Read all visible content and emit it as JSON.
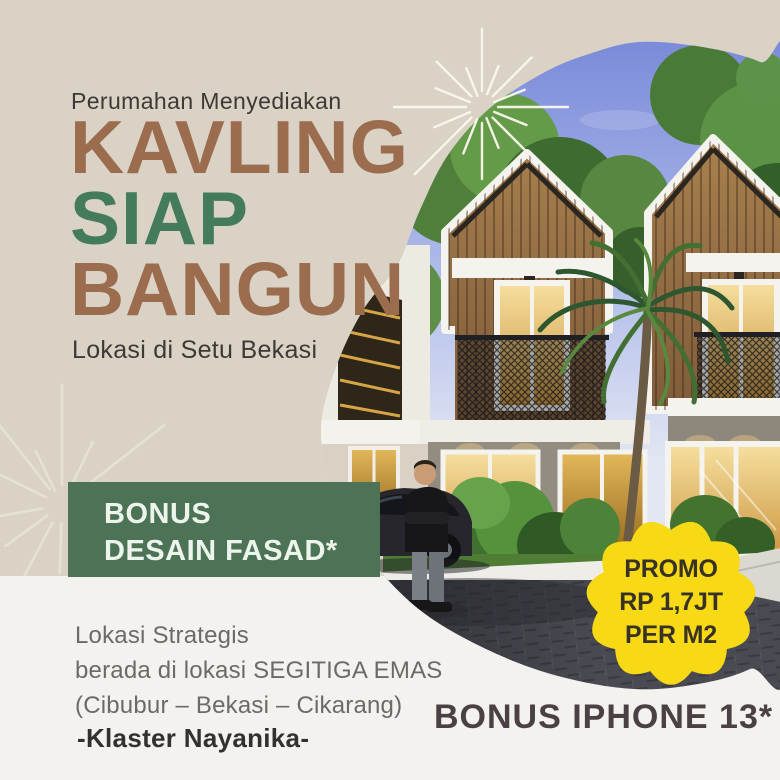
{
  "colors": {
    "canvasBeige": "#D9D2C5",
    "canvasWhite": "#F3F2EF",
    "titleBrown": "#9C6C4E",
    "titleGreen": "#447B5B",
    "ink": "#3E3936",
    "muted": "#6E6966",
    "bannerGreen": "#4D7357",
    "bannerInk": "#EDF4EC",
    "badgeYellow": "#F7D916",
    "badgeInk": "#383226",
    "bonusInk": "#4B4145",
    "clusterInk": "#353030"
  },
  "header": {
    "kicker": "Perumahan Menyediakan",
    "title_line1": "KAVLING",
    "title_line2": "SIAP",
    "title_line3": "BANGUN",
    "subtitle": "Lokasi di Setu Bekasi"
  },
  "bonus_banner": {
    "line1": "BONUS",
    "line2": "DESAIN FASAD*"
  },
  "location": {
    "line1": "Lokasi Strategis",
    "line2": "berada di lokasi SEGITIGA EMAS",
    "line3": "(Cibubur – Bekasi – Cikarang)"
  },
  "cluster_name": "-Klaster Nayanika-",
  "promo_badge": {
    "line1": "PROMO",
    "line2": "RP 1,7JT",
    "line3": "PER M2"
  },
  "footer_bonus": "BONUS IPHONE 13*"
}
